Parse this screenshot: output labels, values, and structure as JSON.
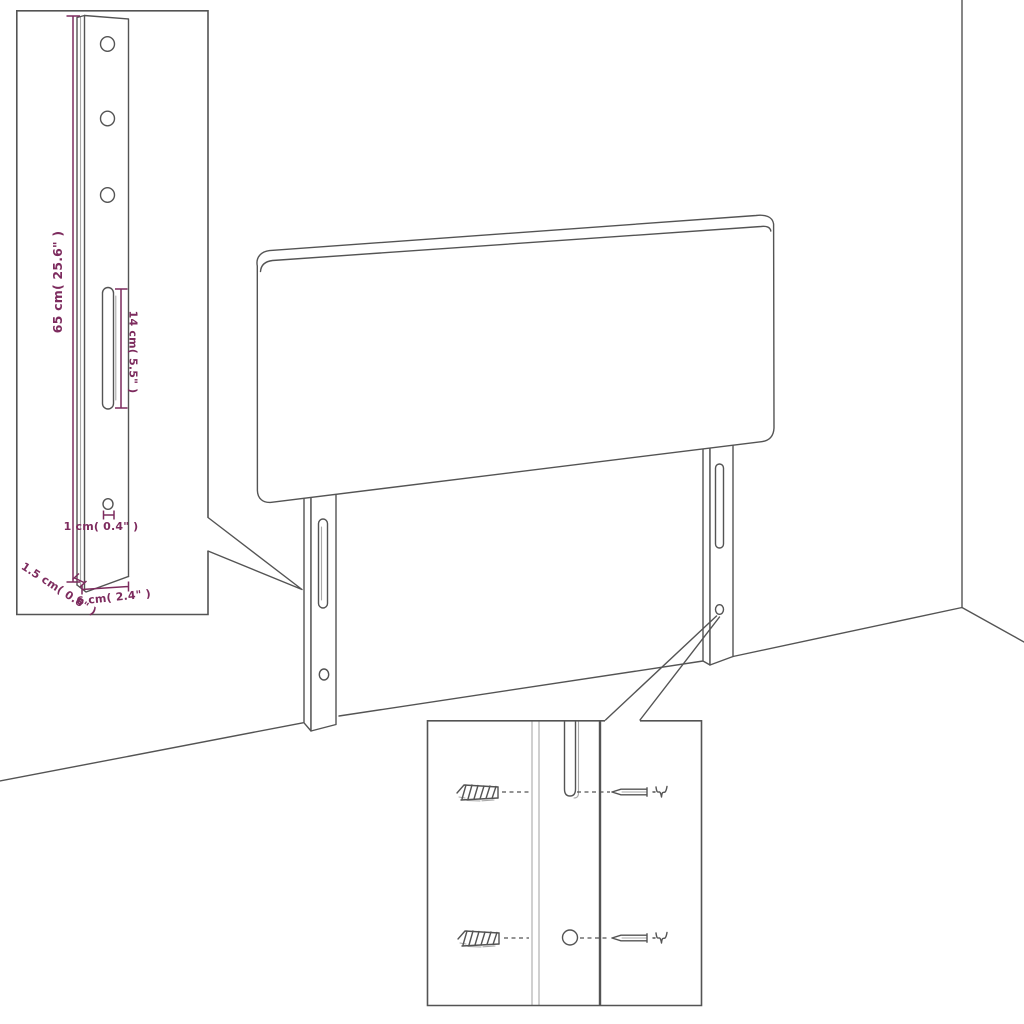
{
  "colors": {
    "background": "#ffffff",
    "line": "#545454",
    "dimension": "#7d2b5e"
  },
  "inset_leg_dimensions": {
    "labels": {
      "height": "65 cm( 25.6\" )",
      "slot_length": "14 cm( 5.5\" )",
      "hole": "1 cm( 0.4\" )",
      "thickness": "1.5 cm( 0.6\" )",
      "width": "6 cm( 2.4\" )"
    }
  }
}
